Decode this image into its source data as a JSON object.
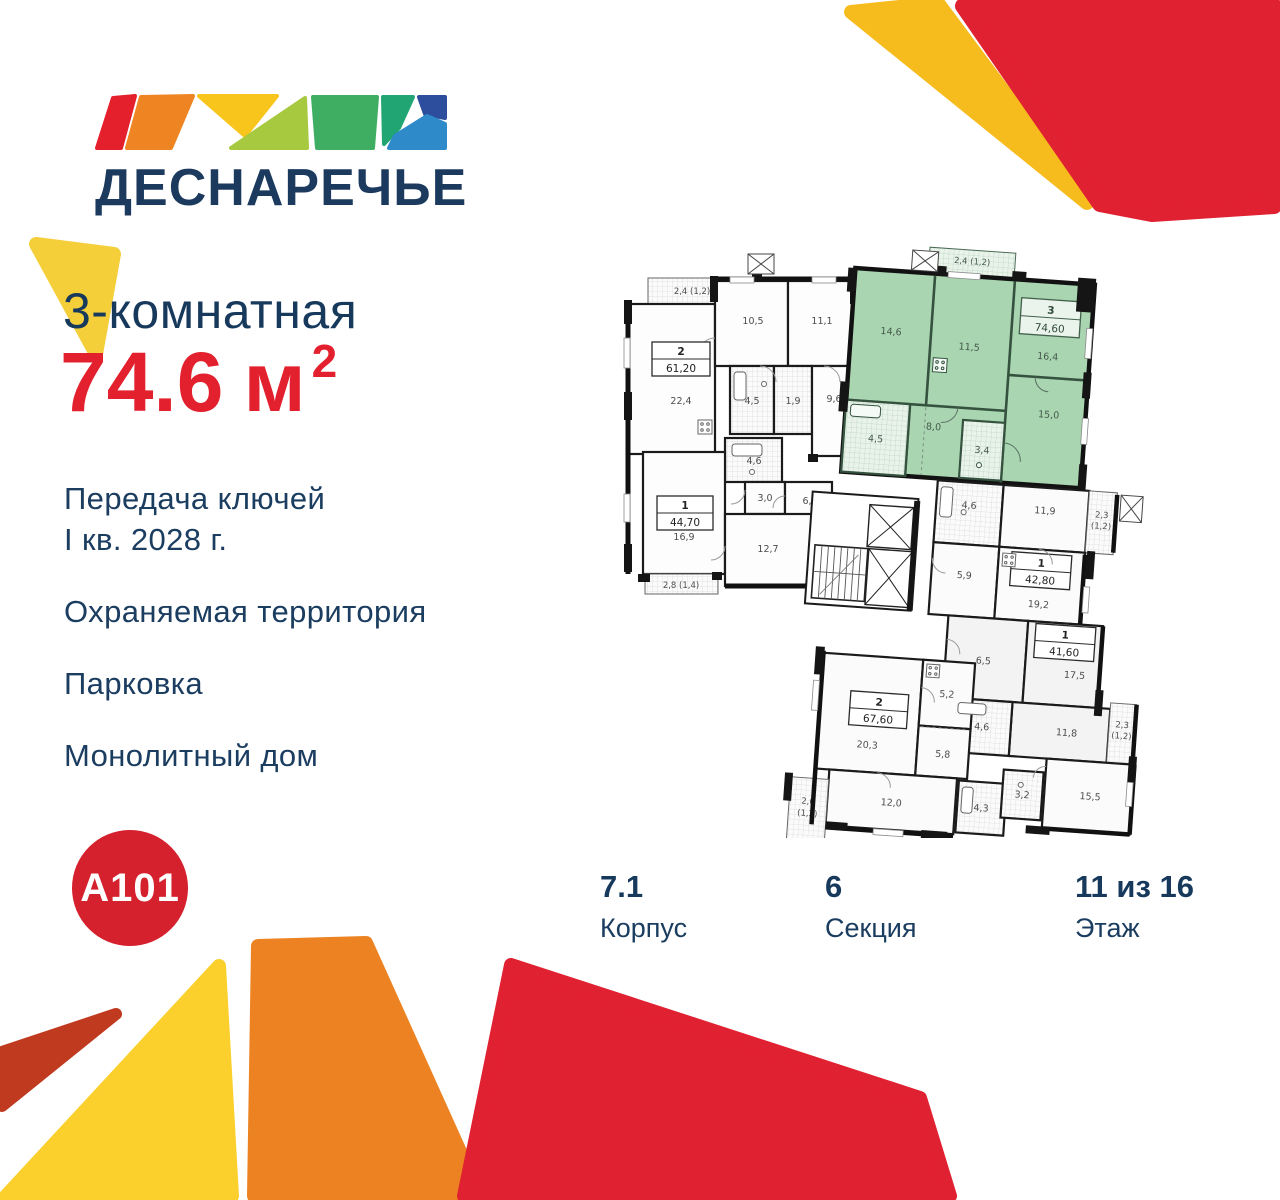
{
  "palette": {
    "navy": "#17395c",
    "red": "#e02131",
    "a101_red": "#d5202d",
    "yellow_beam": "#f6bb1d",
    "yellow_triangle": "#f4cf3a",
    "yellow_bottom": "#fbd02c",
    "orange": "#ec8222",
    "dark_red": "#bf3a1e",
    "plan_highlight": "#a9d5b1"
  },
  "logo": {
    "project_name": "ДЕСНАРЕЧЬЕ",
    "developer_name": "A101"
  },
  "offer": {
    "type_title": "3-комнатная",
    "area_value": "74.6",
    "area_unit": "м",
    "area_power": "2",
    "features": {
      "keys_line1": "Передача ключей",
      "keys_line2": "I кв. 2028 г.",
      "security": "Охраняемая территория",
      "parking": "Парковка",
      "building_type": "Монолитный дом"
    }
  },
  "details": {
    "building": {
      "value": "7.1",
      "label": "Корпус"
    },
    "section": {
      "value": "6",
      "label": "Секция"
    },
    "floor": {
      "value": "11 из 16",
      "label": "Этаж"
    }
  },
  "floorplan": {
    "apartments": {
      "a61": {
        "number": "2",
        "area": "61,20",
        "rooms": {
          "balcony": "2,4 (1,2)",
          "room1": "10,5",
          "room2": "11,1",
          "living": "22,4",
          "bath": "4,5",
          "wc": "1,9",
          "hall": "9,6"
        }
      },
      "a44": {
        "number": "1",
        "area": "44,70",
        "rooms": {
          "bath": "4,6",
          "wc": "3,0",
          "hall": "6,1",
          "living": "16,9",
          "bedroom": "12,7",
          "balcony": "2,8 (1,4)"
        }
      },
      "a74": {
        "number": "3",
        "area": "74,60",
        "rooms": {
          "balcony": "2,4 (1,2)",
          "bedroom1": "14,6",
          "kitchen": "11,5",
          "living": "16,4",
          "hall": "8,0",
          "bath": "4,5",
          "wc": "3,4",
          "bedroom2": "15,0"
        }
      },
      "a42": {
        "number": "1",
        "area": "42,80",
        "rooms": {
          "bath": "4,6",
          "bedroom": "11,9",
          "balcony_line1": "2,3",
          "balcony_line2": "(1,2)",
          "hall": "5,9",
          "living": "19,2"
        }
      },
      "a41": {
        "number": "1",
        "area": "41,60",
        "rooms": {
          "hall": "6,5",
          "living": "17,5",
          "bedroom": "11,8",
          "bath": "4,6",
          "balcony_line1": "2,3",
          "balcony_line2": "(1,2)"
        }
      },
      "a67": {
        "number": "2",
        "area": "67,60",
        "rooms": {
          "living": "20,3",
          "kitchen": "5,2",
          "hall": "5,8",
          "bedroom1": "12,0",
          "bath": "4,3",
          "wc": "3,2",
          "bedroom2": "15,5",
          "balcony_line1": "2,6",
          "balcony_line2": "(1,3)"
        }
      }
    }
  }
}
